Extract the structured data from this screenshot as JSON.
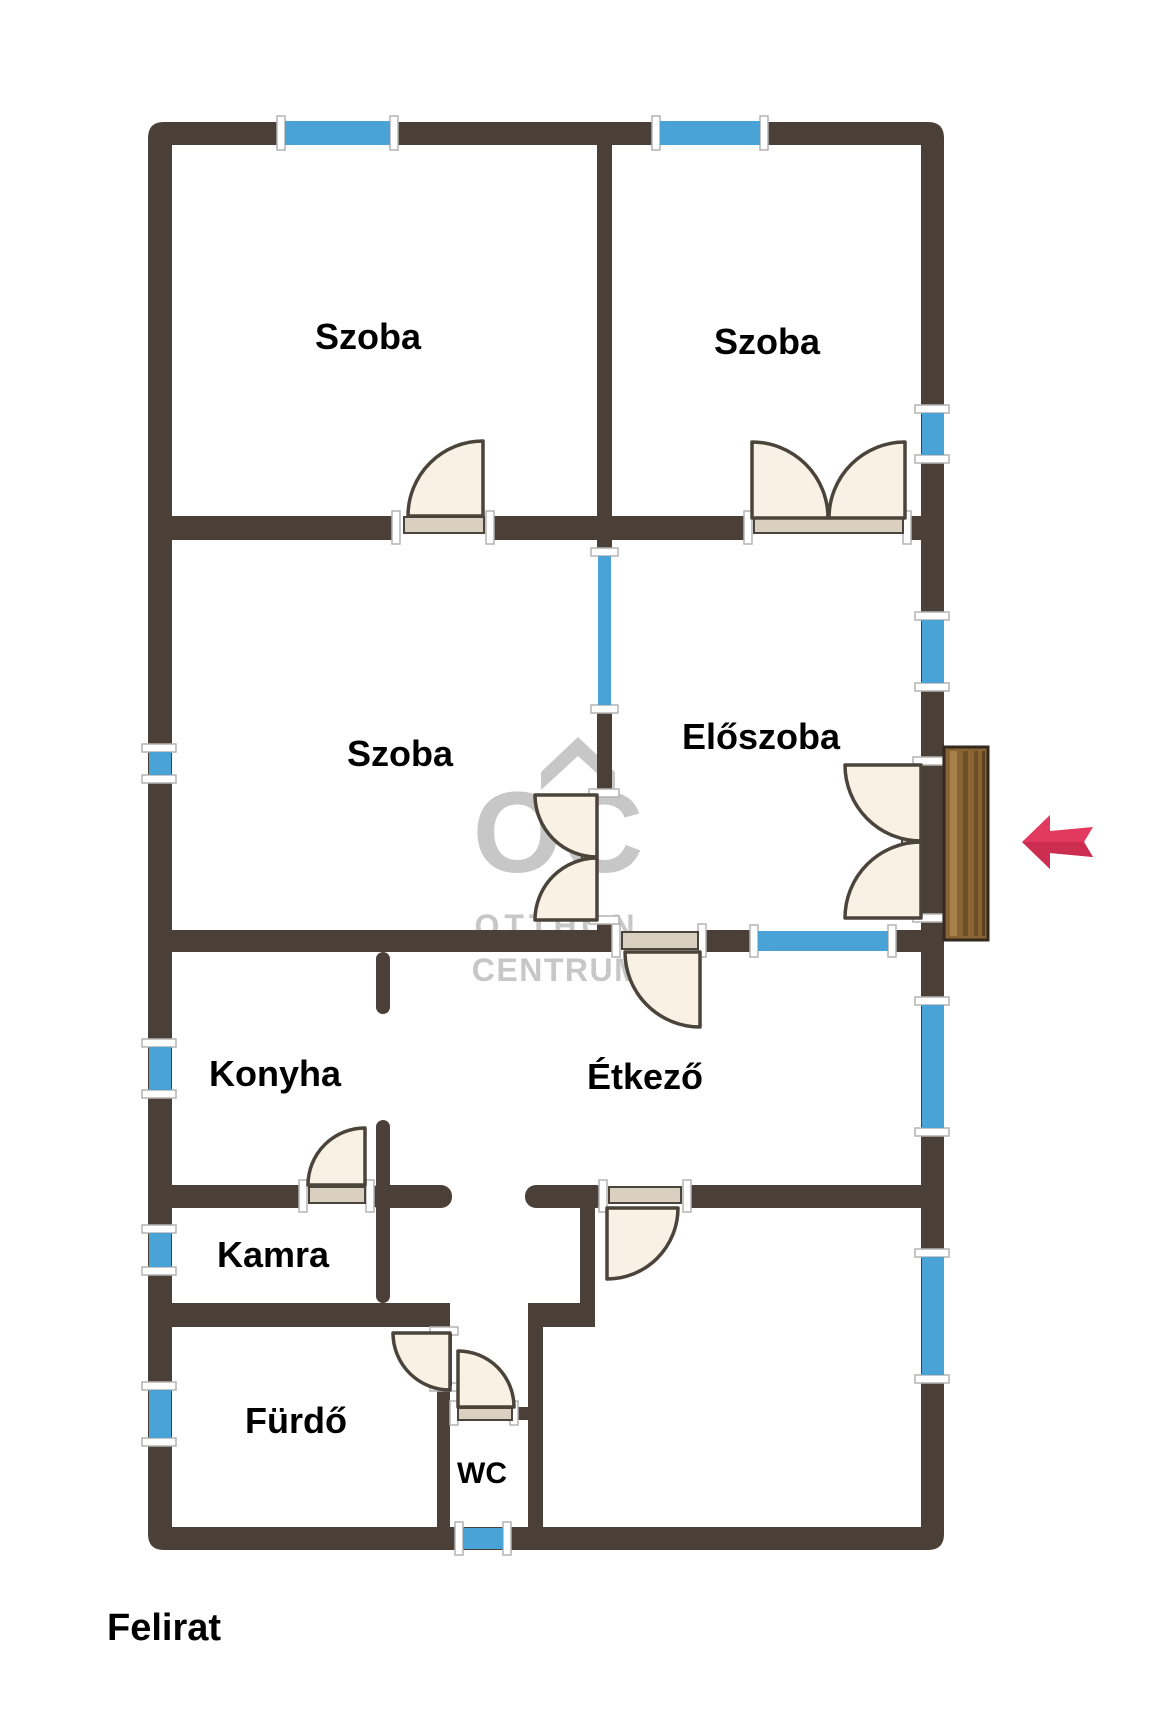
{
  "watermark": {
    "logo_initials": "OC",
    "line1": "OTTHON",
    "line2": "CENTRUM"
  },
  "rooms": {
    "szoba_top_left": {
      "label": "Szoba"
    },
    "szoba_top_right": {
      "label": "Szoba"
    },
    "szoba_middle": {
      "label": "Szoba"
    },
    "eloszoba": {
      "label": "Előszoba"
    },
    "konyha": {
      "label": "Konyha"
    },
    "etkezo": {
      "label": "Étkező"
    },
    "kamra": {
      "label": "Kamra"
    },
    "furdo": {
      "label": "Fürdő"
    },
    "wc": {
      "label": "WC"
    },
    "szoba_bottom": {
      "label": "Szoba"
    }
  },
  "caption": "Felirat",
  "colors": {
    "background": "#ffffff",
    "wall": "#4b4037",
    "window": "#4aa3d6",
    "window_frame": "#ffffff",
    "door_fill": "#f8f1e4",
    "door_leaf": "#d9d0c1",
    "door_stroke": "#4a443b",
    "wood_door": "#8a6534",
    "wood_door_stripe": "#6d4e26",
    "arrow": "#e23a5e",
    "arrow_shade": "#cb2e50",
    "watermark": "#c7c7c7",
    "label_text": "#000000"
  }
}
